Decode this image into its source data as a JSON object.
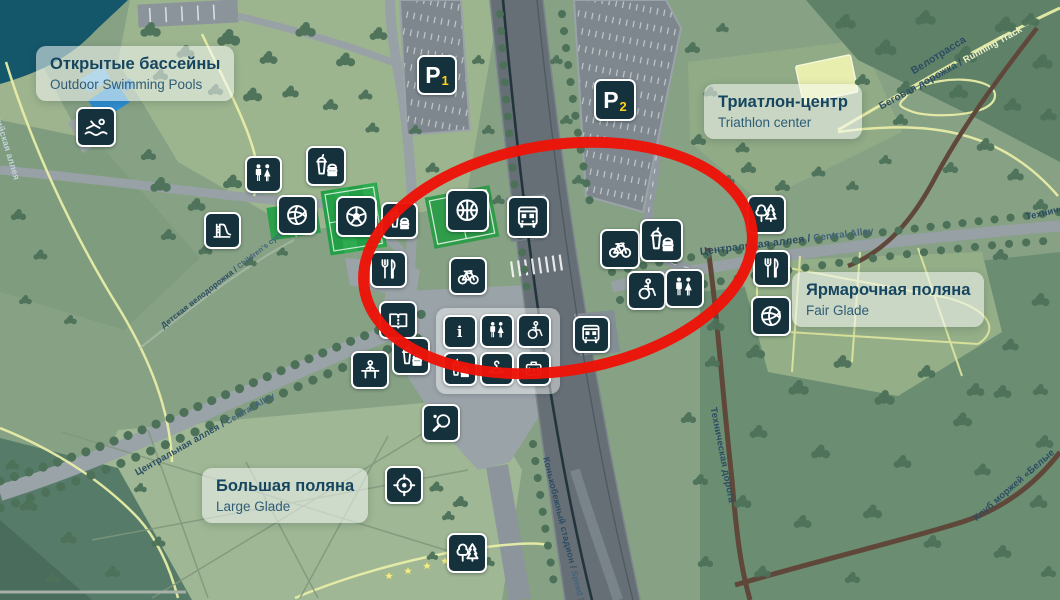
{
  "labels": {
    "pools": {
      "title": "Открытые бассейны",
      "subtitle": "Outdoor Swimming Pools"
    },
    "triathlon": {
      "title": "Триатлон-центр",
      "subtitle": "Triathlon center"
    },
    "fair_glade": {
      "title": "Ярмарочная поляна",
      "subtitle": "Fair Glade"
    },
    "large_glade": {
      "title": "Большая поляна",
      "subtitle": "Large Glade"
    }
  },
  "parking": [
    {
      "label": "P",
      "number": "1",
      "x": 437,
      "y": 75,
      "size": 40
    },
    {
      "label": "P",
      "number": "2",
      "x": 615,
      "y": 100,
      "size": 42
    }
  ],
  "road_labels": [
    {
      "name": "road-label-central-alley-left",
      "ru": "Центральная аллея /",
      "en": "Central Alley",
      "x": 136,
      "y": 468,
      "rot": -29.5,
      "size": 9.5,
      "style": "dark"
    },
    {
      "name": "road-label-central-alley-right",
      "ru": "Центральная аллея /",
      "en": "Central Alley",
      "x": 700,
      "y": 246,
      "rot": -7,
      "size": 10.5,
      "style": "dark"
    },
    {
      "name": "road-label-childrens-cycling-route",
      "ru": "Детская велодорожка /",
      "en": "Children's cycling route",
      "x": 162,
      "y": 322,
      "rot": -38,
      "size": 8,
      "style": "dark"
    },
    {
      "name": "road-label-velotrack",
      "ru": "Велотрасса",
      "en": "",
      "x": 912,
      "y": 66,
      "rot": -32,
      "size": 10.5,
      "style": "dark"
    },
    {
      "name": "road-label-running-track",
      "ru": "Беговая дорожка /",
      "en": "Running Track",
      "x": 880,
      "y": 102,
      "rot": -29,
      "size": 10,
      "style": "light-en"
    },
    {
      "name": "road-label-technical-road-top",
      "ru": "Техническая дорога",
      "en": "",
      "x": 1026,
      "y": 212,
      "rot": -13,
      "size": 9.5,
      "style": "dark"
    },
    {
      "name": "road-label-technical-road",
      "ru": "Техническая дорога",
      "en": "",
      "x": 713,
      "y": 402,
      "rot": 79,
      "size": 9.5,
      "style": "dark"
    },
    {
      "name": "road-label-speed-skating-stadium",
      "ru": "Конькобежный стадион /",
      "en": "Speed Ska",
      "x": 546,
      "y": 452,
      "rot": 76,
      "size": 9,
      "style": "dark"
    },
    {
      "name": "road-label-walrus-club",
      "ru": "Клуб моржей «Белые",
      "en": "",
      "x": 975,
      "y": 514,
      "rot": -41,
      "size": 9.5,
      "style": "dark"
    },
    {
      "name": "road-label-olympic-alley",
      "ru": "Олимпийская аллея",
      "en": "",
      "x": -10,
      "y": 86,
      "rot": 73,
      "size": 9,
      "style": "faint"
    }
  ],
  "icons": [
    {
      "name": "swimming-pool-icon",
      "glyph": "swimmer",
      "x": 96,
      "y": 127,
      "size": 40
    },
    {
      "name": "toilets-icon",
      "glyph": "wc",
      "x": 263,
      "y": 174,
      "size": 37
    },
    {
      "name": "food-court-icon",
      "glyph": "food",
      "x": 326,
      "y": 166,
      "size": 40
    },
    {
      "name": "playground-slide-icon",
      "glyph": "slide",
      "x": 222,
      "y": 230,
      "size": 37
    },
    {
      "name": "volleyball-court-icon",
      "glyph": "volleyball",
      "x": 297,
      "y": 215,
      "size": 40
    },
    {
      "name": "football-field-icon",
      "glyph": "football",
      "x": 356,
      "y": 216,
      "size": 41
    },
    {
      "name": "food-kiosk-icon",
      "glyph": "food",
      "x": 399,
      "y": 220,
      "size": 37
    },
    {
      "name": "restaurant-icon",
      "glyph": "forkknife",
      "x": 388,
      "y": 269,
      "size": 37
    },
    {
      "name": "basketball-court-icon",
      "glyph": "basketball",
      "x": 467,
      "y": 210,
      "size": 43
    },
    {
      "name": "bus-stop-icon",
      "glyph": "bus",
      "x": 528,
      "y": 217,
      "size": 42
    },
    {
      "name": "bike-rental-icon",
      "glyph": "bike",
      "x": 468,
      "y": 276,
      "size": 38
    },
    {
      "name": "bike-rental-icon-2",
      "glyph": "bike",
      "x": 620,
      "y": 249,
      "size": 40
    },
    {
      "name": "food-kiosk-icon-2",
      "glyph": "food",
      "x": 661,
      "y": 240,
      "size": 43
    },
    {
      "name": "accessible-route-icon",
      "glyph": "wheelchair",
      "x": 646,
      "y": 290,
      "size": 39
    },
    {
      "name": "toilets-icon-2",
      "glyph": "wc",
      "x": 684,
      "y": 288,
      "size": 39
    },
    {
      "name": "bus-stop-icon-3",
      "glyph": "bus",
      "x": 591,
      "y": 334,
      "size": 37
    },
    {
      "name": "reading-room-icon",
      "glyph": "book",
      "x": 398,
      "y": 320,
      "size": 38
    },
    {
      "name": "food-kiosk-icon-3",
      "glyph": "food",
      "x": 411,
      "y": 356,
      "size": 38
    },
    {
      "name": "workout-area-icon",
      "glyph": "workout",
      "x": 370,
      "y": 370,
      "size": 38
    },
    {
      "name": "info-point-icon",
      "glyph": "info",
      "x": 460,
      "y": 332,
      "size": 34
    },
    {
      "name": "toilets-icon-3",
      "glyph": "wc",
      "x": 497,
      "y": 331,
      "size": 34
    },
    {
      "name": "accessible-toilet-icon",
      "glyph": "wheelchair",
      "x": 534,
      "y": 331,
      "size": 34
    },
    {
      "name": "food-kiosk-icon-4",
      "glyph": "food",
      "x": 460,
      "y": 369,
      "size": 34
    },
    {
      "name": "cloakroom-icon",
      "glyph": "hanger",
      "x": 497,
      "y": 369,
      "size": 34
    },
    {
      "name": "first-aid-icon",
      "glyph": "firstaid",
      "x": 534,
      "y": 369,
      "size": 34
    },
    {
      "name": "table-tennis-icon",
      "glyph": "tabletennis",
      "x": 441,
      "y": 423,
      "size": 38
    },
    {
      "name": "shooting-range-icon",
      "glyph": "target",
      "x": 404,
      "y": 485,
      "size": 38
    },
    {
      "name": "forest-area-icon",
      "glyph": "trees",
      "x": 467,
      "y": 553,
      "size": 40
    },
    {
      "name": "forest-area-icon-2",
      "glyph": "trees",
      "x": 766,
      "y": 214,
      "size": 39
    },
    {
      "name": "restaurant-icon-2",
      "glyph": "forkknife",
      "x": 771,
      "y": 268,
      "size": 37
    },
    {
      "name": "volleyball-court-icon-2",
      "glyph": "volleyball",
      "x": 771,
      "y": 316,
      "size": 40
    }
  ],
  "annotation": {
    "shape": "ellipse",
    "color": "#ed1408",
    "cx": 558,
    "cy": 258,
    "rx": 196,
    "ry": 113,
    "rotation": -9,
    "stroke_width": 11
  },
  "colors": {
    "tile_bg": "#14313c",
    "tile_border": "#ffffff",
    "annotation_red": "#ed1408",
    "parking_number_yellow": "#ffd21c",
    "water": "#14576a",
    "card_text": "#16455f",
    "sports_field_green": "#23a047",
    "pool_blue": "#2e8fd2",
    "path_yellow": "#e8eda7",
    "road_brown": "#5f4839"
  }
}
